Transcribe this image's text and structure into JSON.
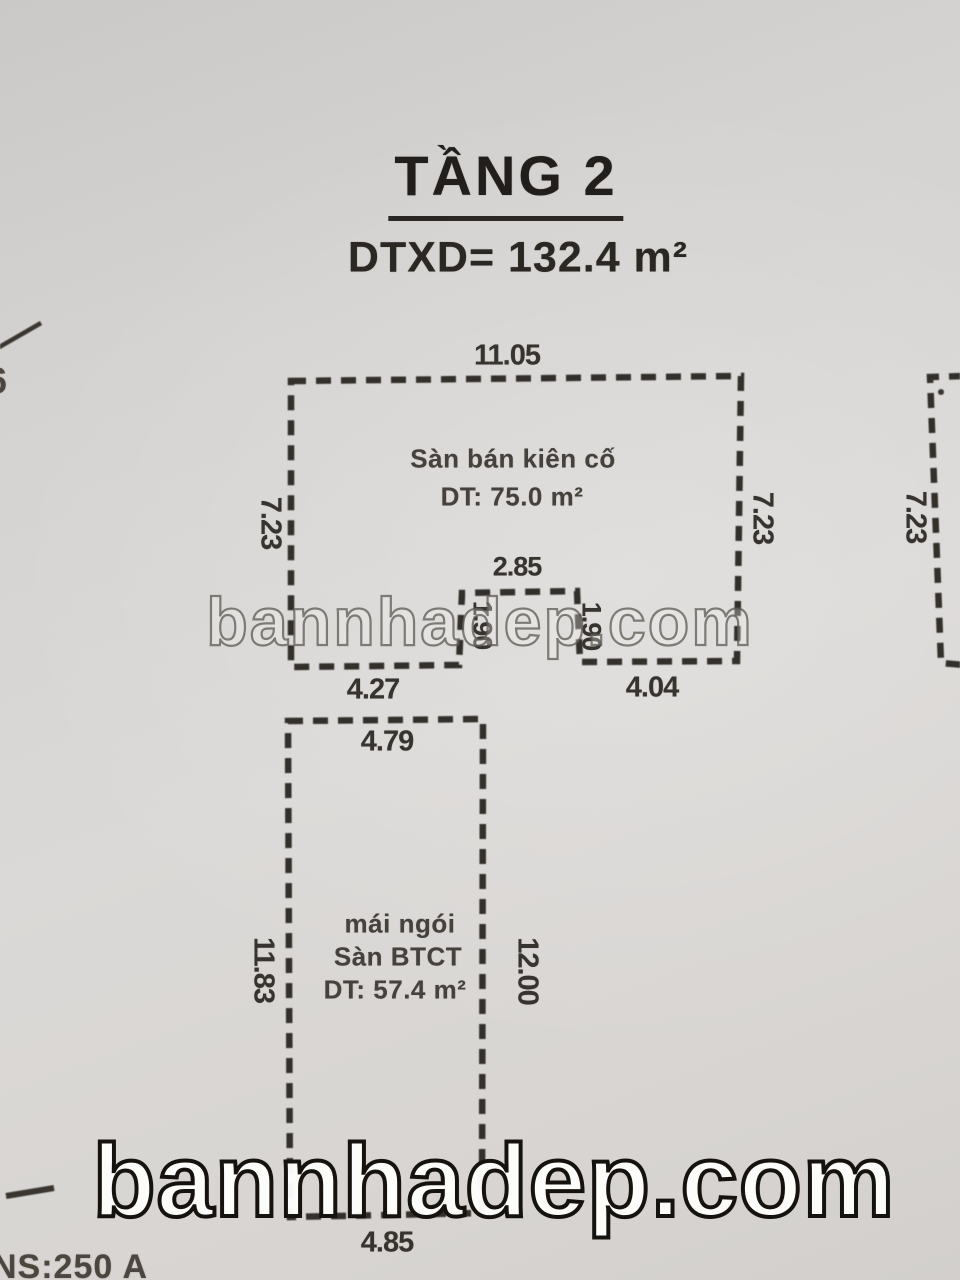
{
  "title": {
    "floor": "TẦNG 2",
    "area": "DTXD= 132.4 m²"
  },
  "top_block": {
    "dim_top": "11.05",
    "dim_left": "7.23",
    "dim_right": "7.23",
    "label_line1": "Sàn bán kiên cố",
    "label_line2": "DT: 75.0 m²",
    "dim_bottom_left": "4.27",
    "dim_bottom_right": "4.04",
    "notch": {
      "dim_top": "2.85",
      "dim_left": "1.90",
      "dim_right": "1.90"
    }
  },
  "bottom_block": {
    "dim_top": "4.79",
    "dim_left": "11.83",
    "dim_right": "12.00",
    "label_line1": "mái ngói",
    "label_line2": "Sàn BTCT",
    "label_line3": "DT: 57.4 m²",
    "dim_bottom": "4.85"
  },
  "adjacent_block": {
    "dim_left": "7.23"
  },
  "margin_notes": {
    "left_partial_digit": "6",
    "bottom_left": "NS:250 A"
  },
  "watermark": {
    "text": "bannhadep.com"
  },
  "colors": {
    "ink": "#332f2b",
    "paper": "#d6d4d2"
  }
}
